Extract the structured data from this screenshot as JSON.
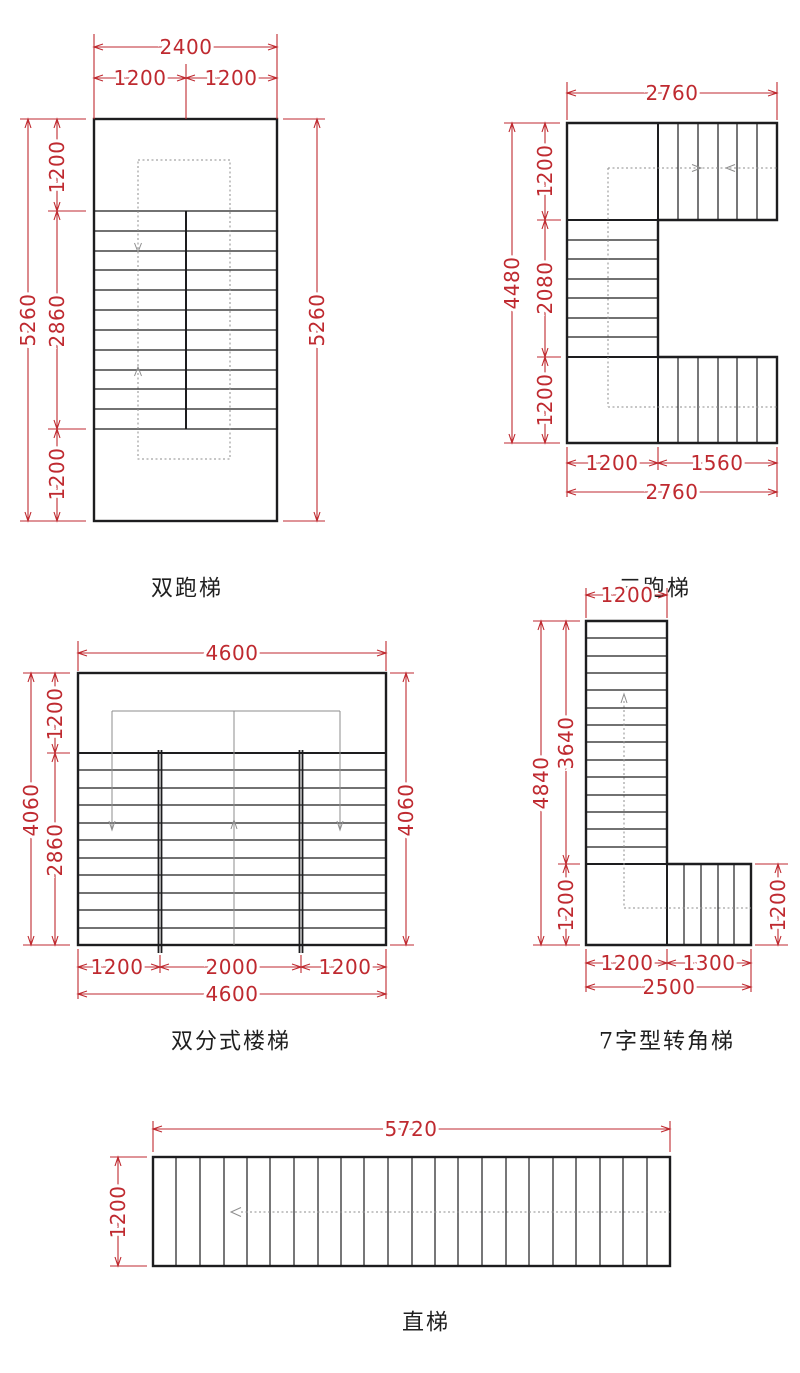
{
  "colors": {
    "dimension_red": "#bf2a30",
    "line_black": "#1d1d1f",
    "walkline_gray": "#8e8e8e",
    "background": "#ffffff"
  },
  "diagrams": {
    "double_run": {
      "label": "双跑梯",
      "dim_total_width": "2400",
      "dim_width_left": "1200",
      "dim_width_right": "1200",
      "dim_total_height_left": "5260",
      "dim_total_height_right": "5260",
      "dim_top_landing": "1200",
      "dim_flight": "2860",
      "dim_bottom_landing": "1200"
    },
    "three_run": {
      "label": "三跑梯",
      "dim_total_width_top": "2760",
      "dim_total_height": "4480",
      "dim_top_landing": "1200",
      "dim_flight": "2080",
      "dim_bottom_landing": "1200",
      "dim_bottom_width_left": "1200",
      "dim_bottom_width_right": "1560",
      "dim_total_width_bottom": "2760"
    },
    "double_split": {
      "label": "双分式楼梯",
      "dim_total_width_top": "4600",
      "dim_total_height_left": "4060",
      "dim_total_height_right": "4060",
      "dim_top_landing": "1200",
      "dim_flight": "2860",
      "dim_bottom_width_left": "1200",
      "dim_bottom_width_center": "2000",
      "dim_bottom_width_right": "1200",
      "dim_total_width_bottom": "4600"
    },
    "corner_7": {
      "label": "7字型转角梯",
      "dim_top_width": "1200",
      "dim_total_height": "4840",
      "dim_flight_height": "3640",
      "dim_landing_height": "1200",
      "dim_arm_height": "1200",
      "dim_bottom_width_left": "1200",
      "dim_bottom_width_right": "1300",
      "dim_total_width_bottom": "2500"
    },
    "straight": {
      "label": "直梯",
      "dim_total_width": "5720",
      "dim_height": "1200"
    }
  }
}
